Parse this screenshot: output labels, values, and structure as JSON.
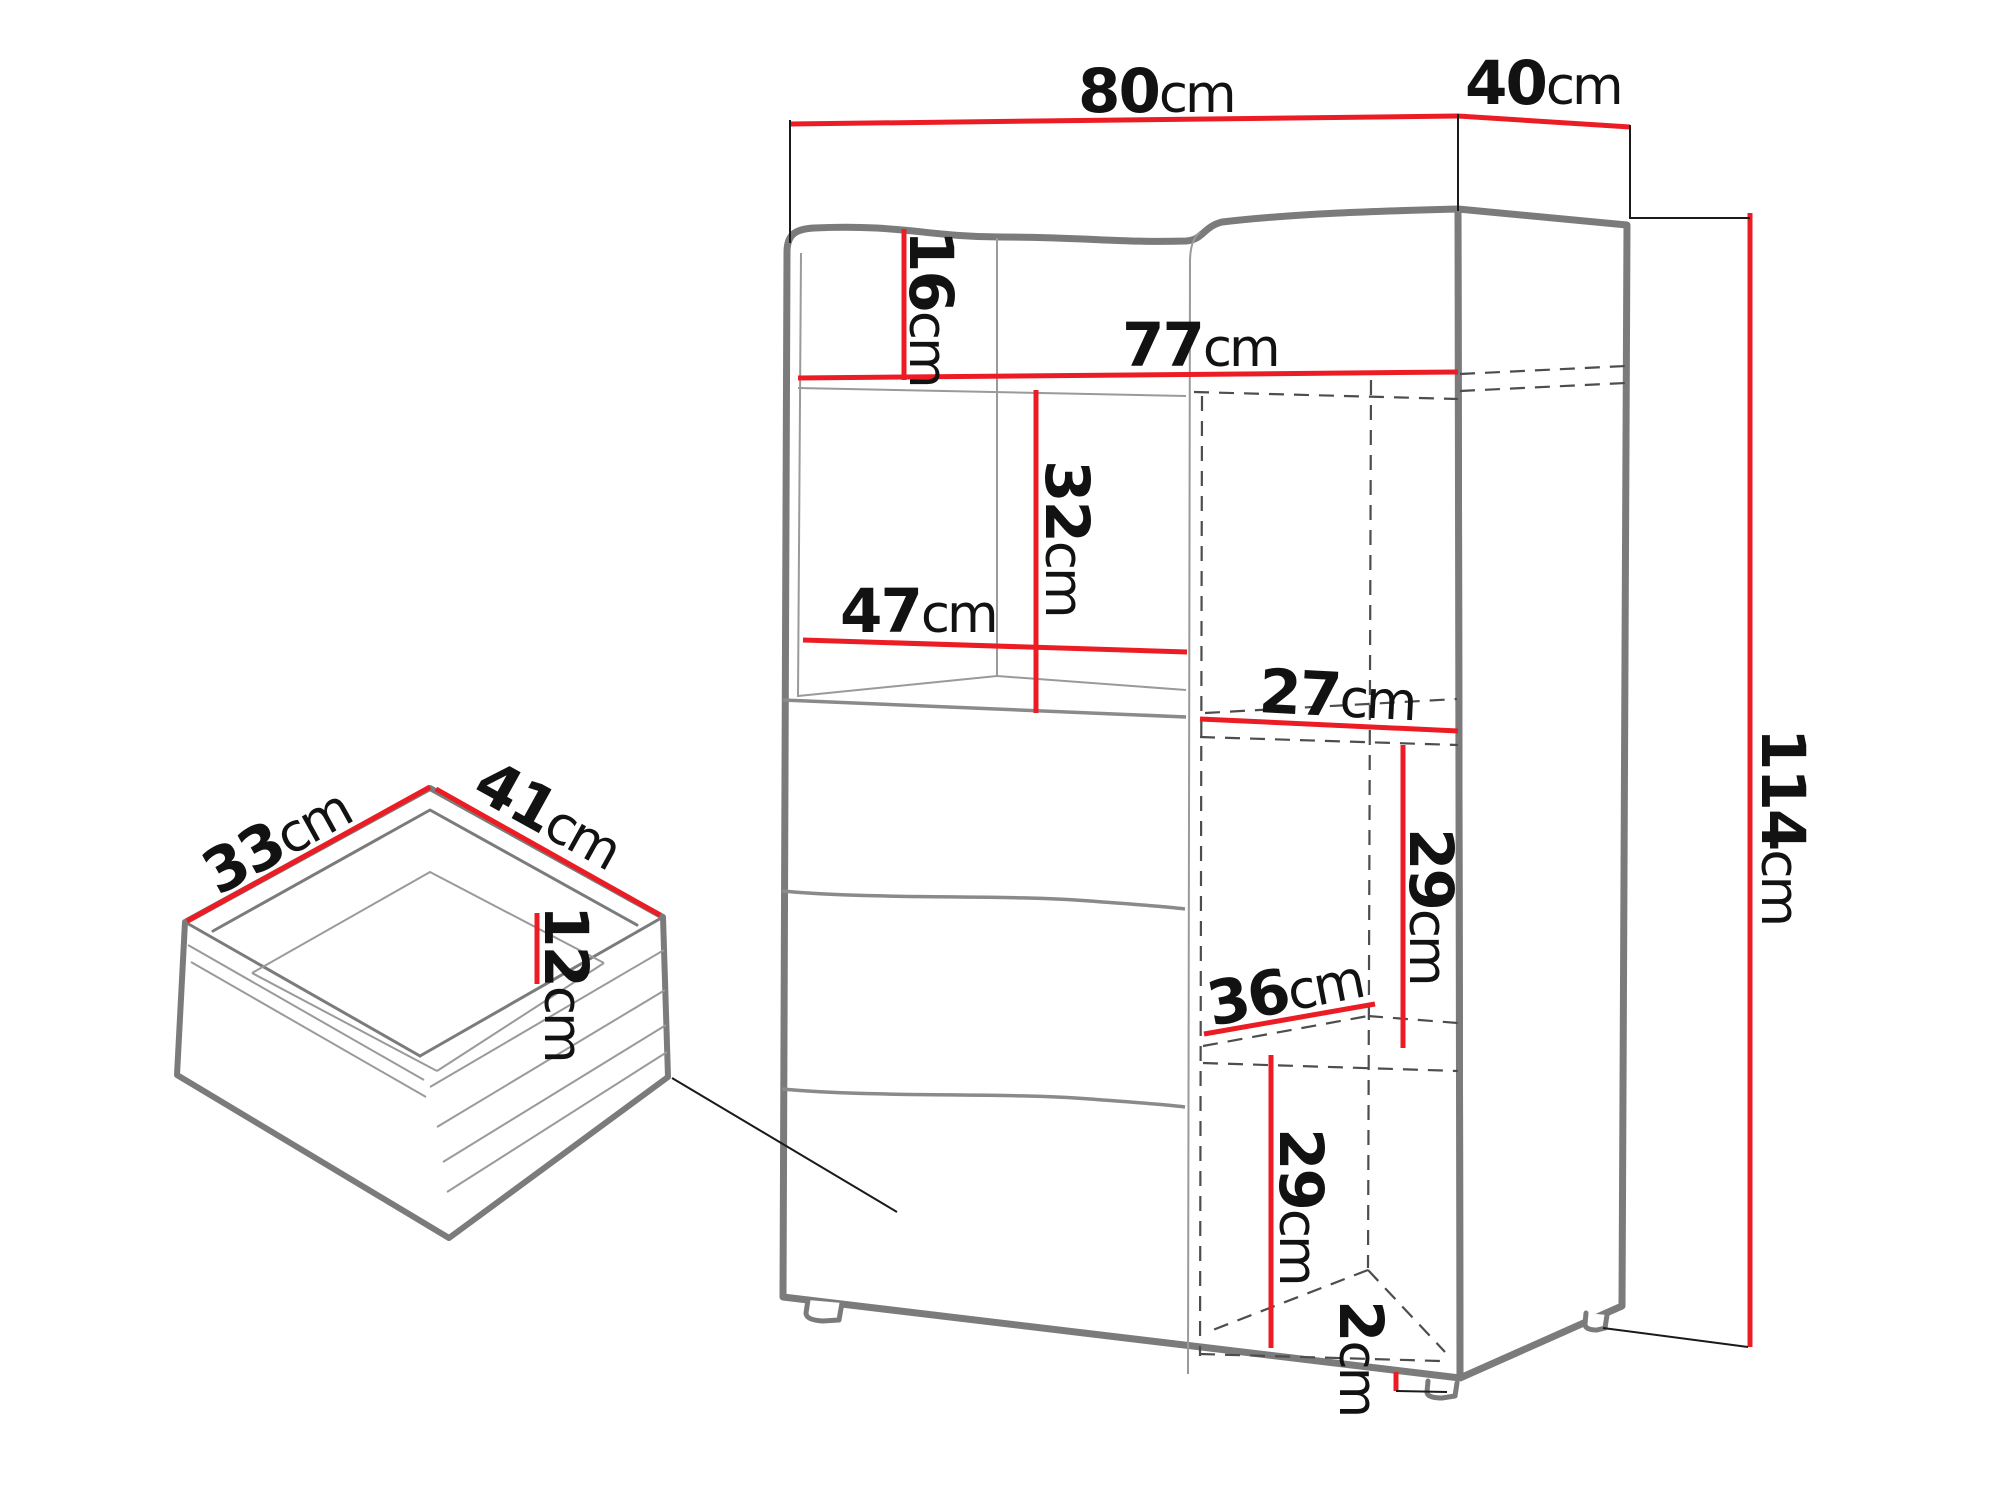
{
  "diagram": {
    "title": "cabinet-dimension-diagram",
    "unit": "cm",
    "cabinet": {
      "width": {
        "value": "80",
        "unit": "cm"
      },
      "depth": {
        "value": "40",
        "unit": "cm"
      },
      "height": {
        "value": "114",
        "unit": "cm"
      },
      "top_niche_height": {
        "value": "16",
        "unit": "cm"
      },
      "interior_width": {
        "value": "77",
        "unit": "cm"
      },
      "niche_height": {
        "value": "32",
        "unit": "cm"
      },
      "niche_width": {
        "value": "47",
        "unit": "cm"
      },
      "upper_shelf_depth": {
        "value": "27",
        "unit": "cm"
      },
      "upper_compartment_height": {
        "value": "29",
        "unit": "cm"
      },
      "lower_shelf_depth": {
        "value": "36",
        "unit": "cm"
      },
      "lower_compartment_height": {
        "value": "29",
        "unit": "cm"
      },
      "foot_height": {
        "value": "2",
        "unit": "cm"
      }
    },
    "drawer": {
      "depth": {
        "value": "33",
        "unit": "cm"
      },
      "width": {
        "value": "41",
        "unit": "cm"
      },
      "height": {
        "value": "12",
        "unit": "cm"
      }
    },
    "colors": {
      "dimension_line": "#ec1c24",
      "outline": "#7b7b7b",
      "dashed_line": "#4d4d4d",
      "text": "#121212"
    }
  }
}
